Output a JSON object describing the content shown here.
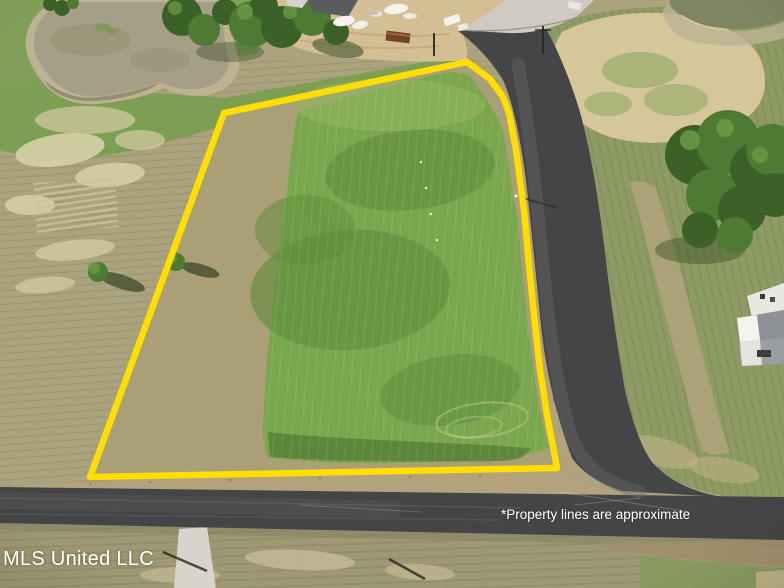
{
  "overlay": {
    "watermark": "MLS United LLC",
    "disclaimer": "*Property lines are approximate"
  },
  "property": {
    "boundary_points": "224,113 467,62 490,79 503,97 509,113 516,150 524,210 529,265 534,315 540,370 547,415 557,468 90,477",
    "boundary_color": "#ffde00"
  },
  "scene_features": [
    "vacant-lot",
    "pond",
    "construction-site",
    "asphalt-road",
    "concrete-road",
    "tree-cluster",
    "neighbor-house",
    "grass-field"
  ],
  "colors": {
    "boundary": "#ffde00",
    "asphalt": "#454547",
    "asphaltLight": "#6a6a6e",
    "concrete": "#cfcbc2",
    "grassBright": "#7aa64e",
    "grassDark": "#5f8c3c",
    "grassMid": "#7d9f54",
    "grassOlive": "#8f9b65",
    "fieldTan": "#aaa37d",
    "interiorTan": "#ab9f78",
    "dirtSand": "#d3bf93",
    "dirtLight": "#d6c69c",
    "shoulderTan": "#b2a37c",
    "pondWater": "#a69f87",
    "pondShore": "#bdb393",
    "pondDark": "#7d8562",
    "treeDark": "#3c6128",
    "treeMid": "#4e7a33",
    "treeLight": "#6d9a45",
    "houseRoof": "#9b9ea1",
    "houseWall": "#f3f3f0",
    "white": "#ffffff",
    "dumpster": "#6f4527"
  }
}
